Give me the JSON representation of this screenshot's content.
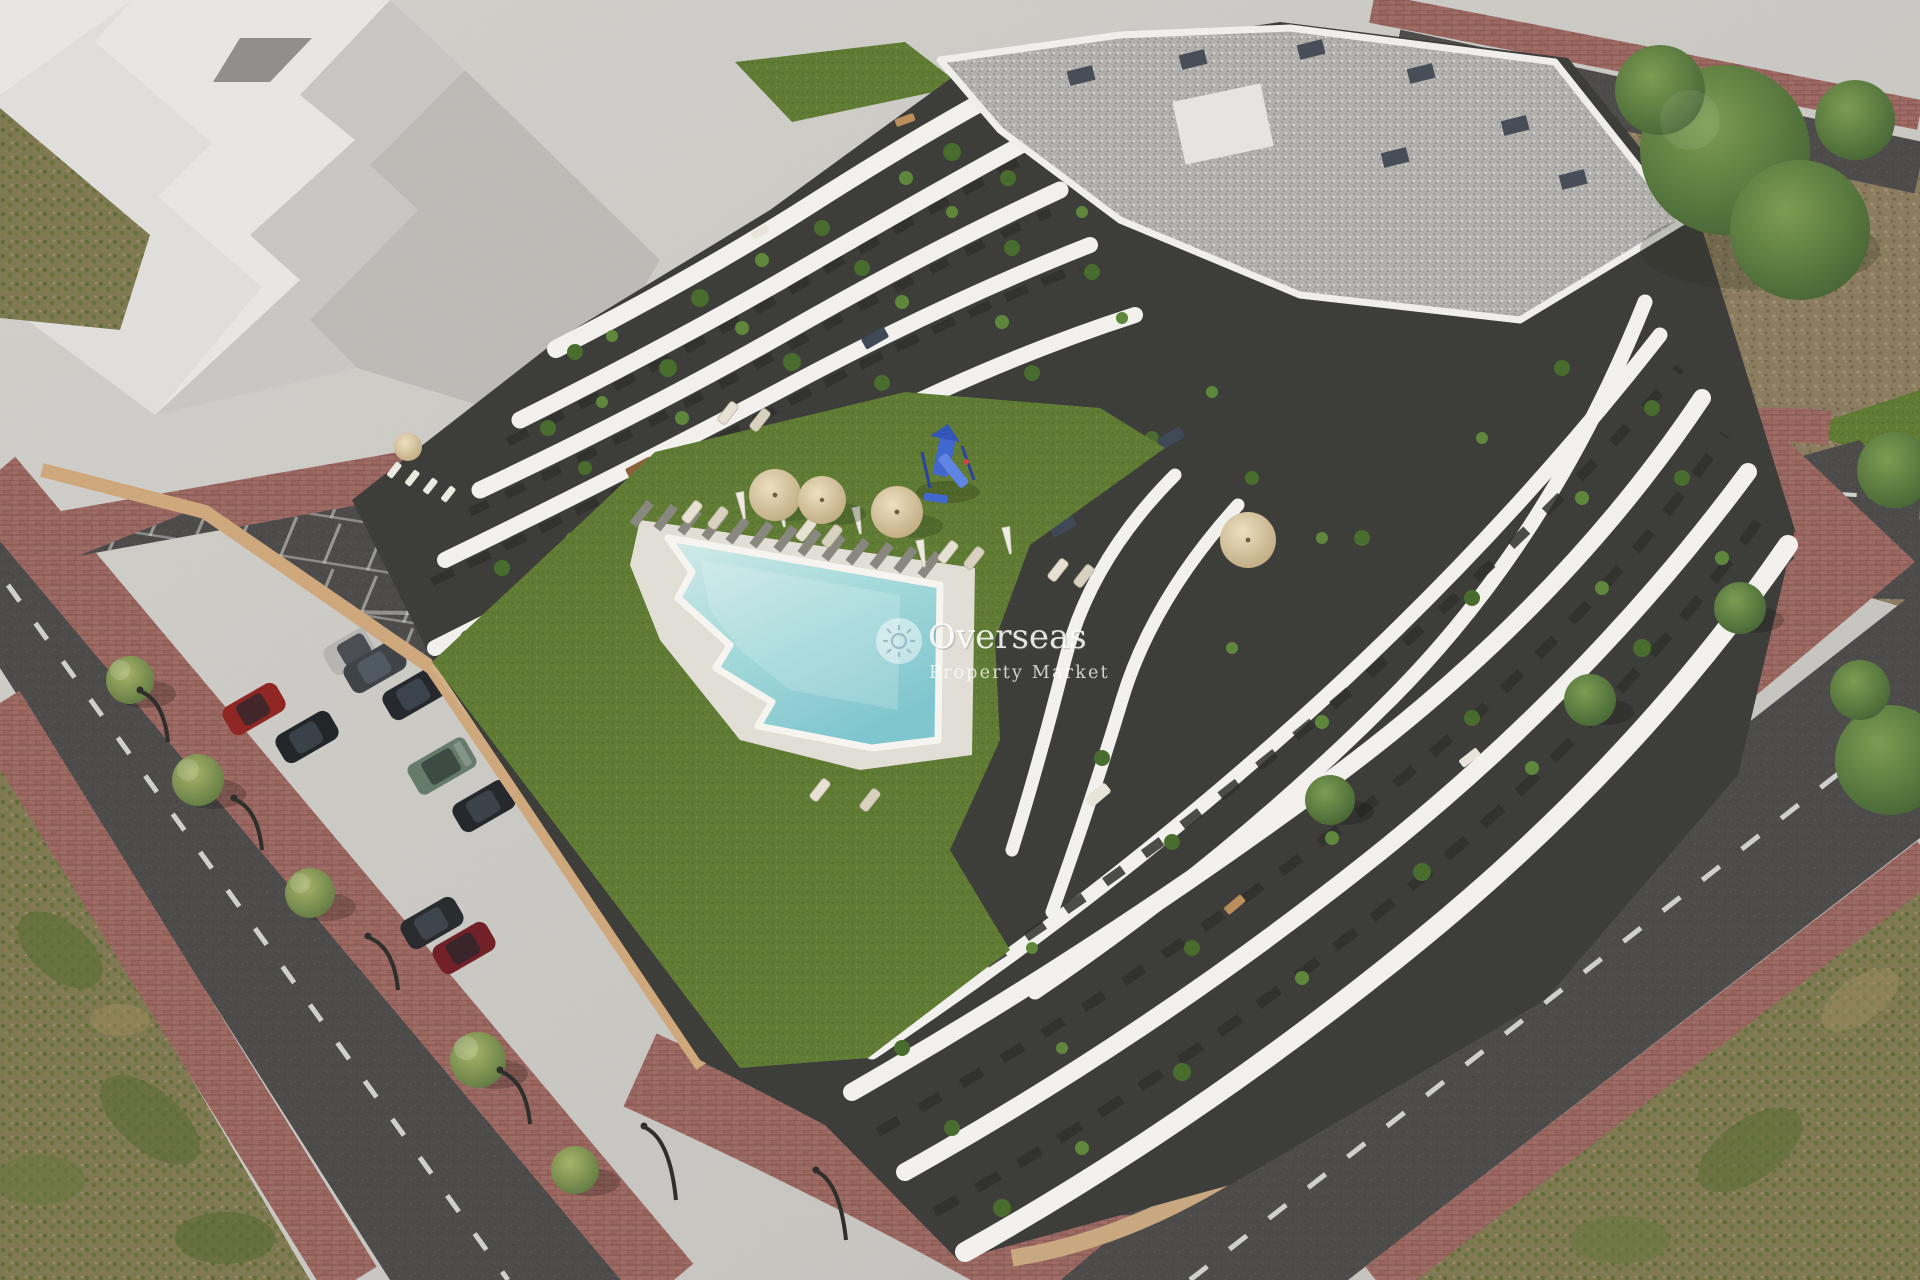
{
  "scene": {
    "type": "aerial architectural rendering",
    "subject": "Modern terraced apartment complex with communal lawn, free-form pool, playground, sunken parking lot and surrounding streets",
    "watermark": {
      "brand": "Overseas",
      "tagline": "Property Market",
      "icon": "sun-logo"
    },
    "palette": {
      "pavement": "#cbc9c4",
      "asphalt": "#4a4948",
      "sidewalk_paver": "#9d6a63",
      "lawn": "#5e7a31",
      "pool_water": "#9fd6d8",
      "building_light": "#f3f2ee",
      "building_dark": "#3a3a37",
      "retaining_wall": "#c9a87f",
      "scrub": "#7d7850",
      "dirt": "#8a7b5e",
      "roof_gravel": "#b2b1ae",
      "playground_blue": "#3e66cf"
    },
    "features": {
      "parked_cars": 9,
      "pool_umbrellas": 4,
      "sun_loungers": 12,
      "street_trees": 10,
      "playground": "blue slide tower"
    },
    "cars": [
      {
        "color": "#b7b5b1"
      },
      {
        "color": "#3e4144"
      },
      {
        "color": "#22252a"
      },
      {
        "color": "#8e2320"
      },
      {
        "color": "#1f2326"
      },
      {
        "color": "#647a68"
      },
      {
        "color": "#212528"
      },
      {
        "color": "#26282b"
      },
      {
        "color": "#701d24"
      }
    ]
  }
}
